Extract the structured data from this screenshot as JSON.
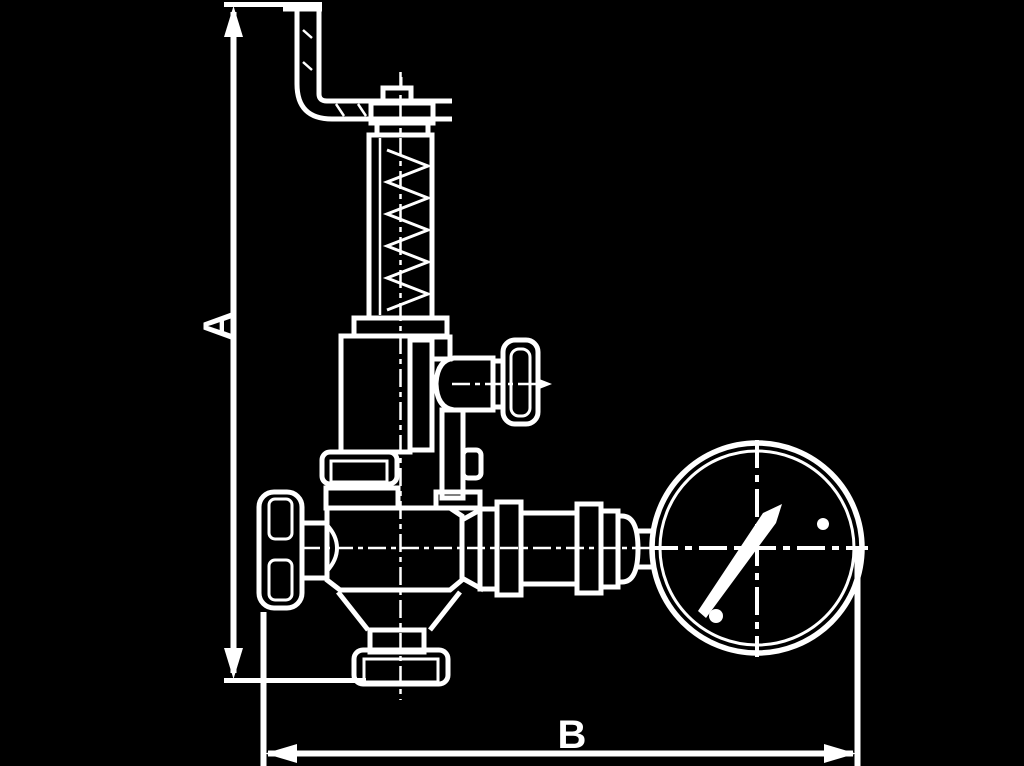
{
  "diagram": {
    "kind": "valve-dimension-drawing",
    "dimensions": {
      "vertical_label": "A",
      "horizontal_label": "B"
    },
    "colors": {
      "background": "#000000",
      "line": "#ffffff"
    }
  }
}
